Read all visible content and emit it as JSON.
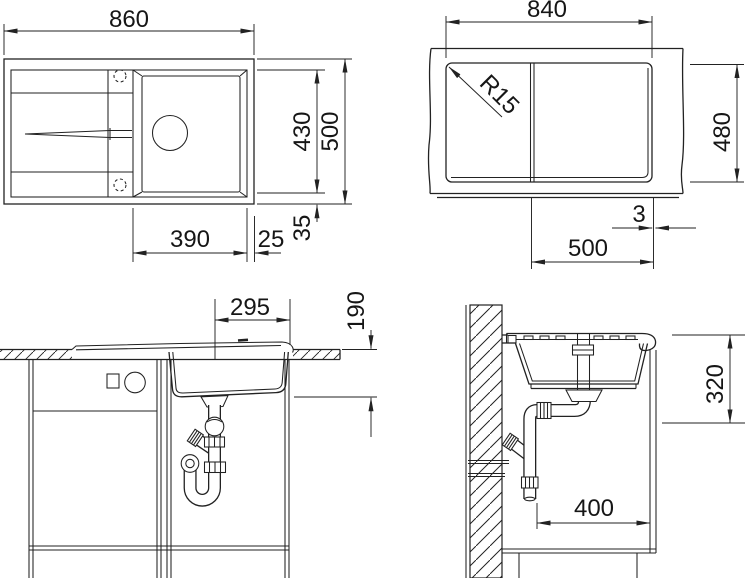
{
  "drawing": {
    "type": "sink installation technical drawing",
    "colors": {
      "ink": "#222222",
      "background": "#ffffff"
    },
    "views": {
      "plan": {
        "name": "sink plan view",
        "dims": {
          "overall_width": "860",
          "overall_depth": "500",
          "bowl_depth": "430",
          "bowl_width": "390",
          "side_gap": "25",
          "front_gap": "35"
        }
      },
      "cutout": {
        "name": "worktop cutout view",
        "dims": {
          "cutout_width": "840",
          "corner_radius": "R15",
          "cutout_depth": "480",
          "edge_gap": "3",
          "bowl_section": "500"
        }
      },
      "front": {
        "name": "front section view",
        "dims": {
          "drain_offset": "295",
          "bowl_height": "190"
        }
      },
      "side": {
        "name": "side section view",
        "dims": {
          "mounting_depth": "320",
          "wall_clearance": "400"
        }
      }
    }
  }
}
